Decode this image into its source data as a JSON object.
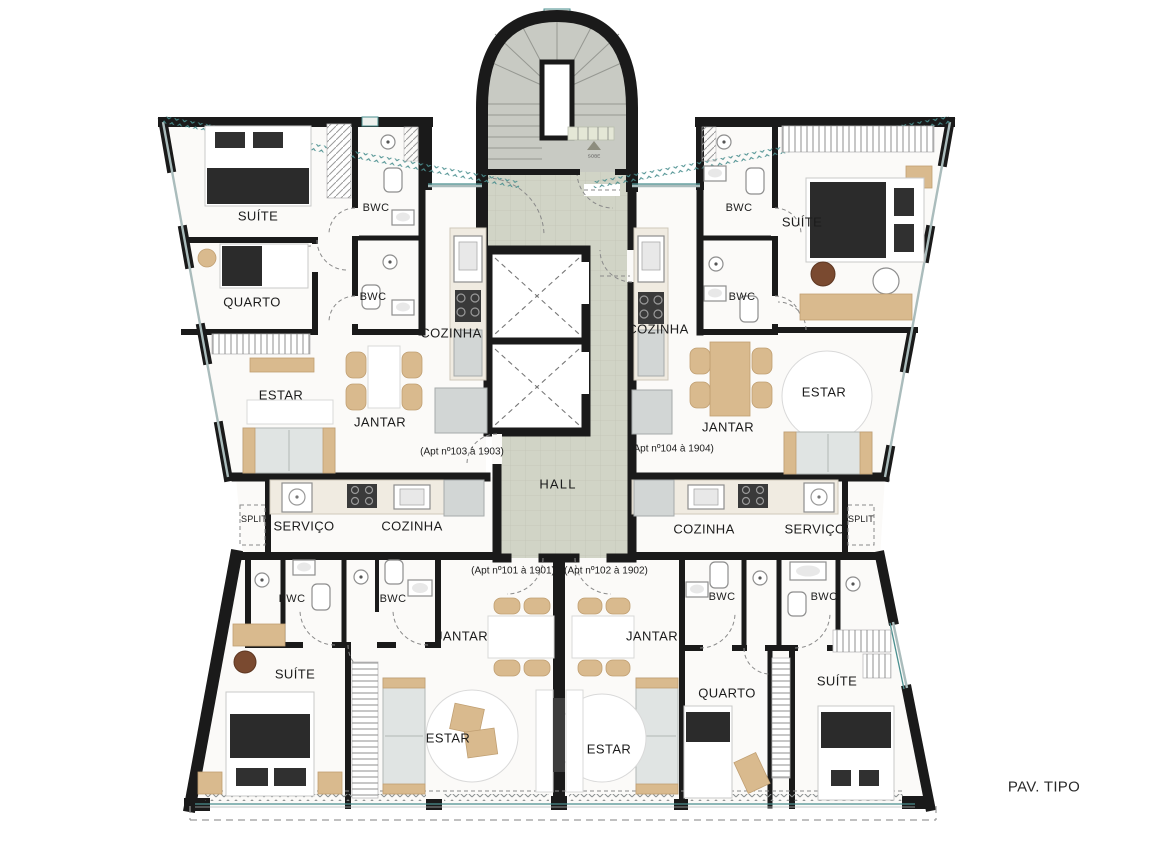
{
  "floor_plan": {
    "title": "PAV. TIPO",
    "core": {
      "hall": "HALL",
      "stairs_note": "SOBE"
    },
    "apartments": {
      "apt_103": {
        "note": "(Apt nº103 à 1903)",
        "rooms": {
          "suite": "SUÍTE",
          "quarto": "QUARTO",
          "bwc_1": "BWC",
          "bwc_2": "BWC",
          "cozinha": "COZINHA",
          "estar": "ESTAR",
          "jantar": "JANTAR"
        }
      },
      "apt_104": {
        "note": "(Apt nº104 à 1904)",
        "rooms": {
          "suite": "SUÍTE",
          "bwc_1": "BWC",
          "bwc_2": "BWC",
          "cozinha": "COZINHA",
          "estar": "ESTAR",
          "jantar": "JANTAR"
        }
      },
      "apt_101": {
        "note": "(Apt nº101 à 1901)",
        "rooms": {
          "suite": "SUÍTE",
          "bwc_1": "BWC",
          "bwc_2": "BWC",
          "cozinha": "COZINHA",
          "servico": "SERVIÇO",
          "split": "SPLIT",
          "estar": "ESTAR",
          "jantar": "JANTAR"
        }
      },
      "apt_102": {
        "note": "(Apt nº102 à 1902)",
        "rooms": {
          "suite": "SUÍTE",
          "quarto": "QUARTO",
          "bwc_1": "BWC",
          "bwc_2": "BWC",
          "cozinha": "COZINHA",
          "servico": "SERVIÇO",
          "split": "SPLIT",
          "estar": "ESTAR",
          "jantar": "JANTAR"
        }
      }
    },
    "colors": {
      "wall": "#1a1a1a",
      "hall_floor": "#d1d4c6",
      "stair_floor": "#c8cac3",
      "wood": "#d9ba8e",
      "window_frame": "#4a8f8f",
      "dark_furniture": "#2b2b2b"
    }
  }
}
